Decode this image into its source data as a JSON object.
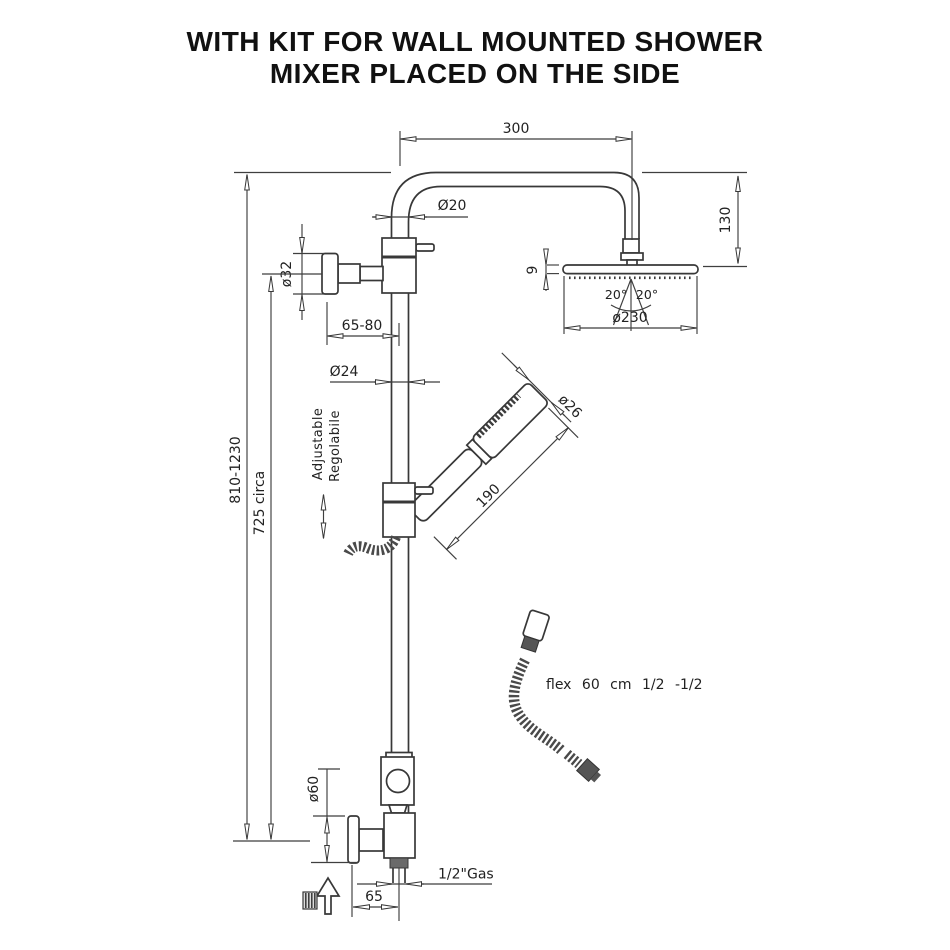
{
  "title": {
    "line1": "WITH KIT FOR WALL MOUNTED SHOWER",
    "line2": "MIXER PLACED ON THE SIDE"
  },
  "dimensions": {
    "arm_length": "300",
    "arm_diameter": "Ø20",
    "head_drop": "130",
    "head_thickness": "9",
    "spray_angle_left": "20°",
    "spray_angle_right": "20°",
    "head_diameter": "ø230",
    "wall_flange_diameter": "ø32",
    "wall_clearance": "65-80",
    "riser_diameter": "Ø24",
    "handshower_diameter": "ø26",
    "handshower_length": "190",
    "overall_height": "810-1230",
    "riser_height": "725 circa",
    "base_flange_diameter": "ø60",
    "inlet_thread": "1/2\"Gas",
    "inlet_offset": "65"
  },
  "labels": {
    "adjustable_en": "Adjustable",
    "adjustable_it": "Regolabile",
    "flex_hose": "flex 60 cm 1/2 -1/2"
  }
}
